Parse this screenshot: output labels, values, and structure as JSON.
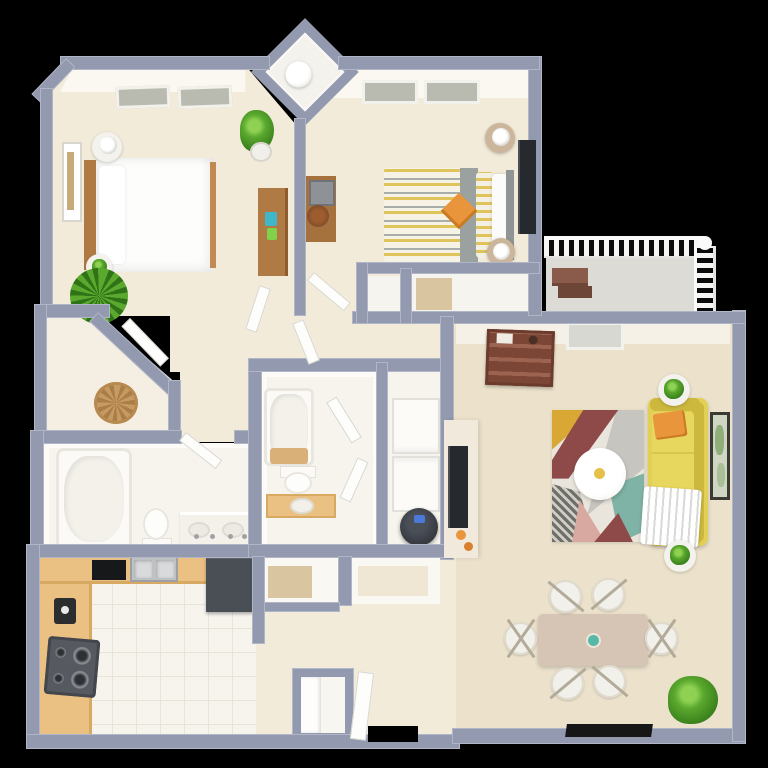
{
  "scene": {
    "type": "3d-floor-plan-render",
    "view": "top-down dollhouse",
    "background": "#000000",
    "unit": "2 bedroom / 2 bathroom apartment with balcony",
    "visible_text": []
  },
  "palette": {
    "wall": "#939ab0",
    "wallLight": "#b7bccb",
    "floor": "#f3ebd9",
    "floorLiving": "#ece2cc",
    "floorWhite": "#f7f4ee",
    "ceiling": "#fbfaf6",
    "balcony": "#dcdbd6",
    "counter": "#ebc183",
    "wood": "#b07a44",
    "woodDark": "#7c4636",
    "sofa": "#e2cf55",
    "sofaDark": "#cdb83e",
    "rug": "#eae5dc",
    "rugGray": "#c6c5bf",
    "maroon": "#8e4a49",
    "mustard": "#d9a733",
    "teal": "#7fb3a5",
    "pink": "#d8a9a0",
    "plant": "#5aa82e",
    "plantDark": "#2f7316",
    "dark": "#33363c",
    "tv": "#26292e",
    "steel": "#bfc2c4",
    "orange": "#e8953c",
    "mat": "#161616",
    "basket": "#c69a62",
    "tan": "#d9c5a0",
    "blue": "#4a79d9",
    "chair": "#f2f0ea",
    "duvetYellow": "#dfc45c",
    "duvetGray": "#a9aeab",
    "table": "#d6c5b4"
  },
  "rooms": [
    {
      "id": "bedroom-1",
      "position": "top-left",
      "furniture": [
        "double-bed",
        "wood-headboard",
        "round-nightstand-with-lamp",
        "round-nightstand-with-plant",
        "palm-plant",
        "tall-potted-plant",
        "dresser",
        "wall-art",
        "ceiling-vent",
        "ceiling-vent",
        "door"
      ]
    },
    {
      "id": "utility-closet-diamond",
      "position": "top-center",
      "furniture": [
        "water-heater"
      ]
    },
    {
      "id": "bedroom-2",
      "position": "top-right",
      "furniture": [
        "double-bed-striped-duvet",
        "accent-pillow",
        "nightstand-lamp",
        "nightstand-lamp",
        "wall-tv",
        "desk",
        "stool",
        "ceiling-vent",
        "ceiling-vent"
      ]
    },
    {
      "id": "balcony",
      "position": "right",
      "furniture": [
        "railing",
        "bench"
      ]
    },
    {
      "id": "hall-closets",
      "position": "center",
      "furniture": [
        "closet-small",
        "closet-wide"
      ]
    },
    {
      "id": "walk-in-closet",
      "position": "left",
      "furniture": [
        "wicker-basket"
      ]
    },
    {
      "id": "bathroom-1",
      "position": "left-middle",
      "furniture": [
        "bathtub",
        "toilet",
        "double-vanity"
      ]
    },
    {
      "id": "bathroom-2",
      "position": "center-middle",
      "furniture": [
        "bathtub",
        "bath-mat",
        "toilet",
        "vanity-sink",
        "door",
        "door"
      ]
    },
    {
      "id": "laundry-closet",
      "position": "center",
      "furniture": [
        "stacked-washer-dryer",
        "robot-vacuum"
      ]
    },
    {
      "id": "kitchen",
      "position": "bottom-left",
      "furniture": [
        "l-shaped-counter",
        "stove",
        "range-hood",
        "double-sink",
        "refrigerator",
        "coffee-maker"
      ]
    },
    {
      "id": "entry-hall",
      "position": "bottom-center",
      "furniture": [
        "closet-shelving",
        "coat-closet",
        "open-door",
        "front-door-opening"
      ]
    },
    {
      "id": "living-dining",
      "position": "bottom-right",
      "furniture": [
        "bar-shelf",
        "media-console",
        "wall-tv",
        "area-rug",
        "coffee-table",
        "yellow-sofa",
        "throw-blanket",
        "accent-pillow",
        "side-table-plant",
        "side-table-plant",
        "wall-art",
        "ceiling-vent",
        "dining-table",
        "dining-chair",
        "dining-chair",
        "dining-chair",
        "dining-chair",
        "dining-chair",
        "dining-chair",
        "potted-plant",
        "door-mat"
      ]
    }
  ]
}
